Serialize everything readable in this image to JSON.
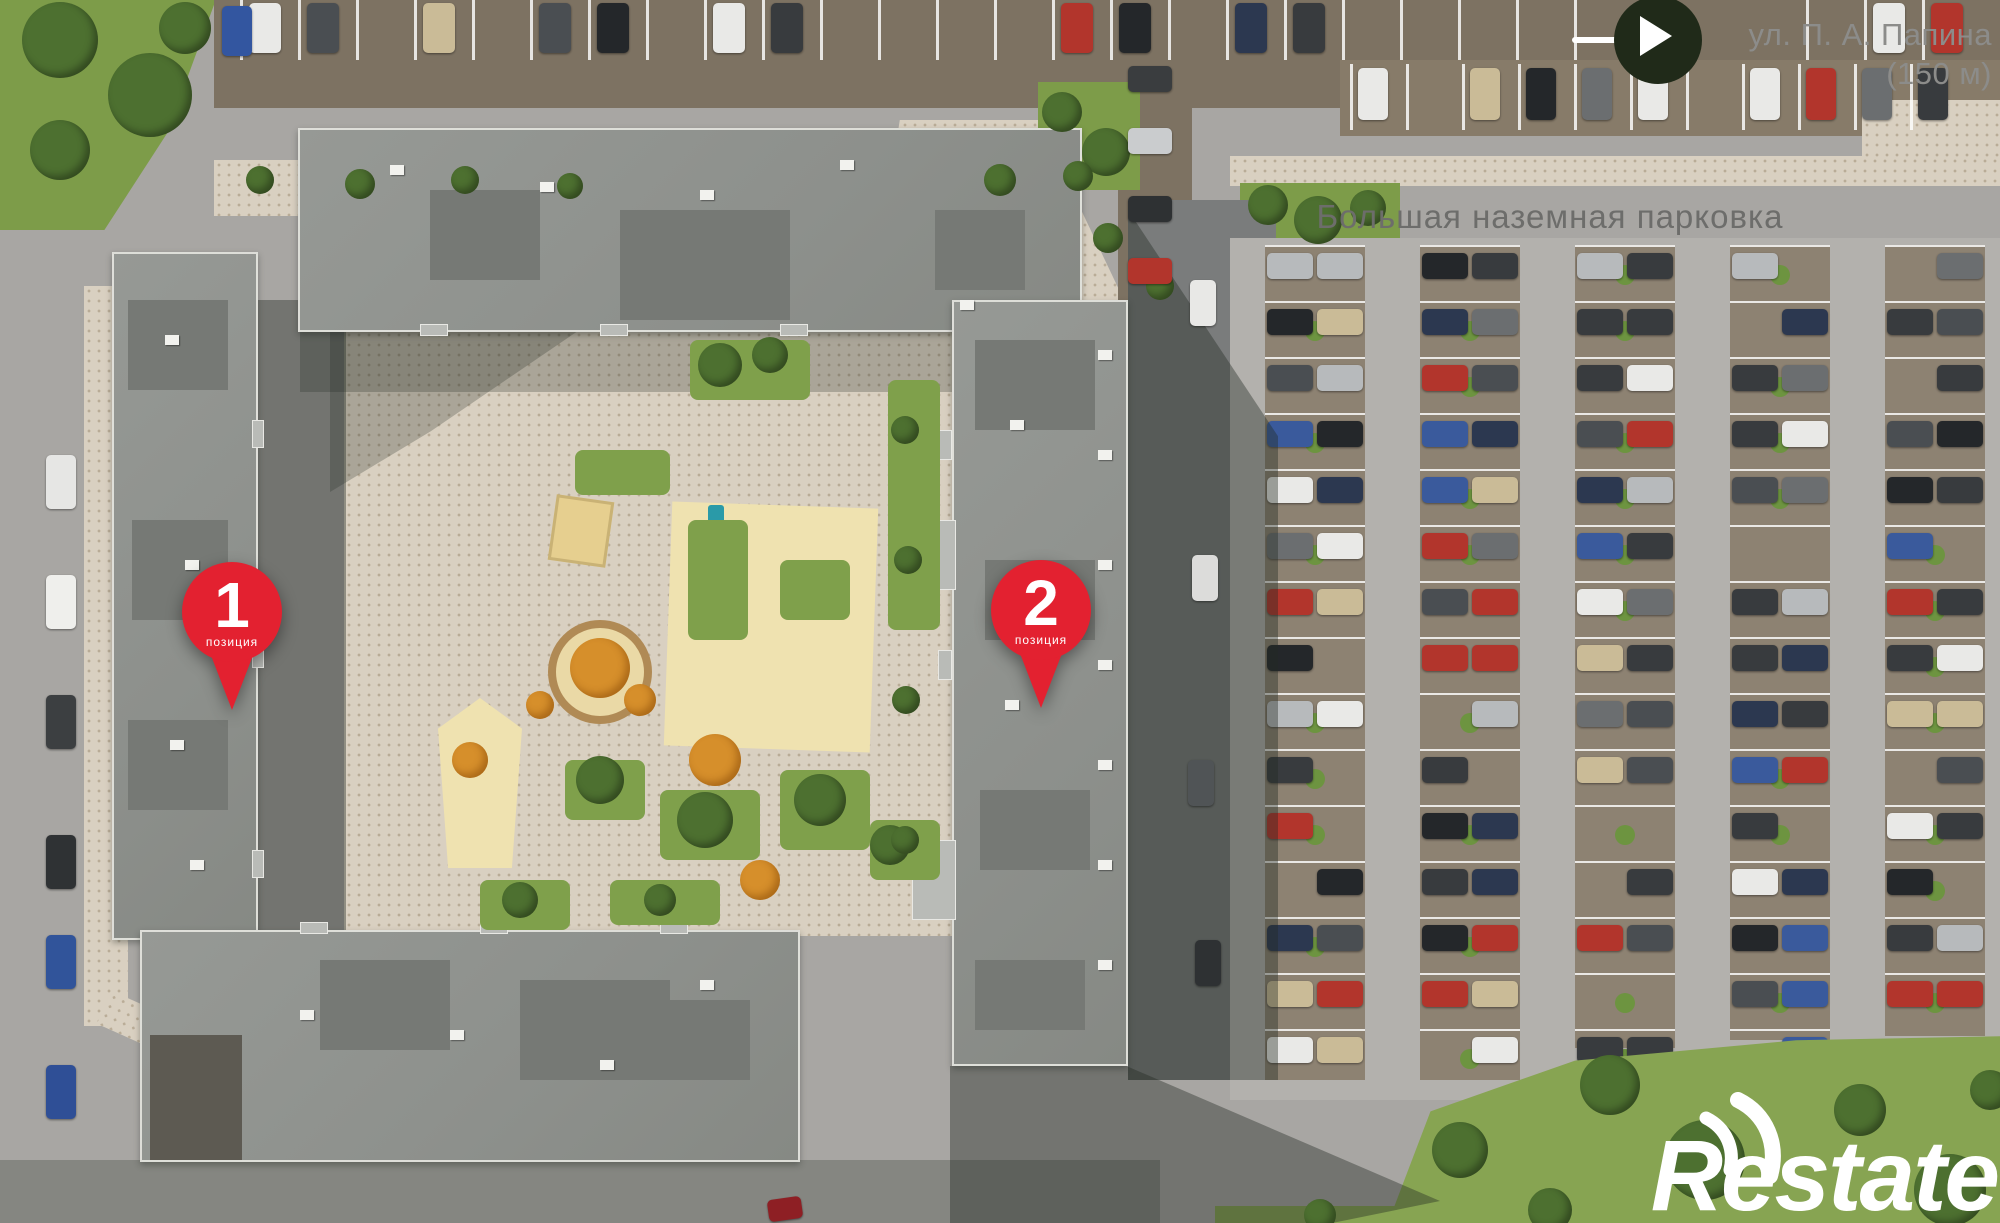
{
  "site_plan": {
    "street_label": {
      "line1": "ул. П. А. Папина",
      "line2": "(150 м)"
    },
    "parking_label": "Большая наземная парковка",
    "pins": [
      {
        "number": "1",
        "caption": "позиция"
      },
      {
        "number": "2",
        "caption": "позиция"
      }
    ],
    "watermark": {
      "text": "Restate"
    },
    "colors": {
      "pin_red": "#e32130",
      "parking_label_gray": "#6d6d6b",
      "street_label_gray": "#8c8c8a",
      "arrow_circle_bg": "#202a19",
      "grass_green": "#7d9c49",
      "roof_gray": "#8f928e",
      "pavement_beige": "#d9d0c1",
      "road_gray": "#a8a6a3",
      "watermark_white": "#ffffff"
    }
  }
}
